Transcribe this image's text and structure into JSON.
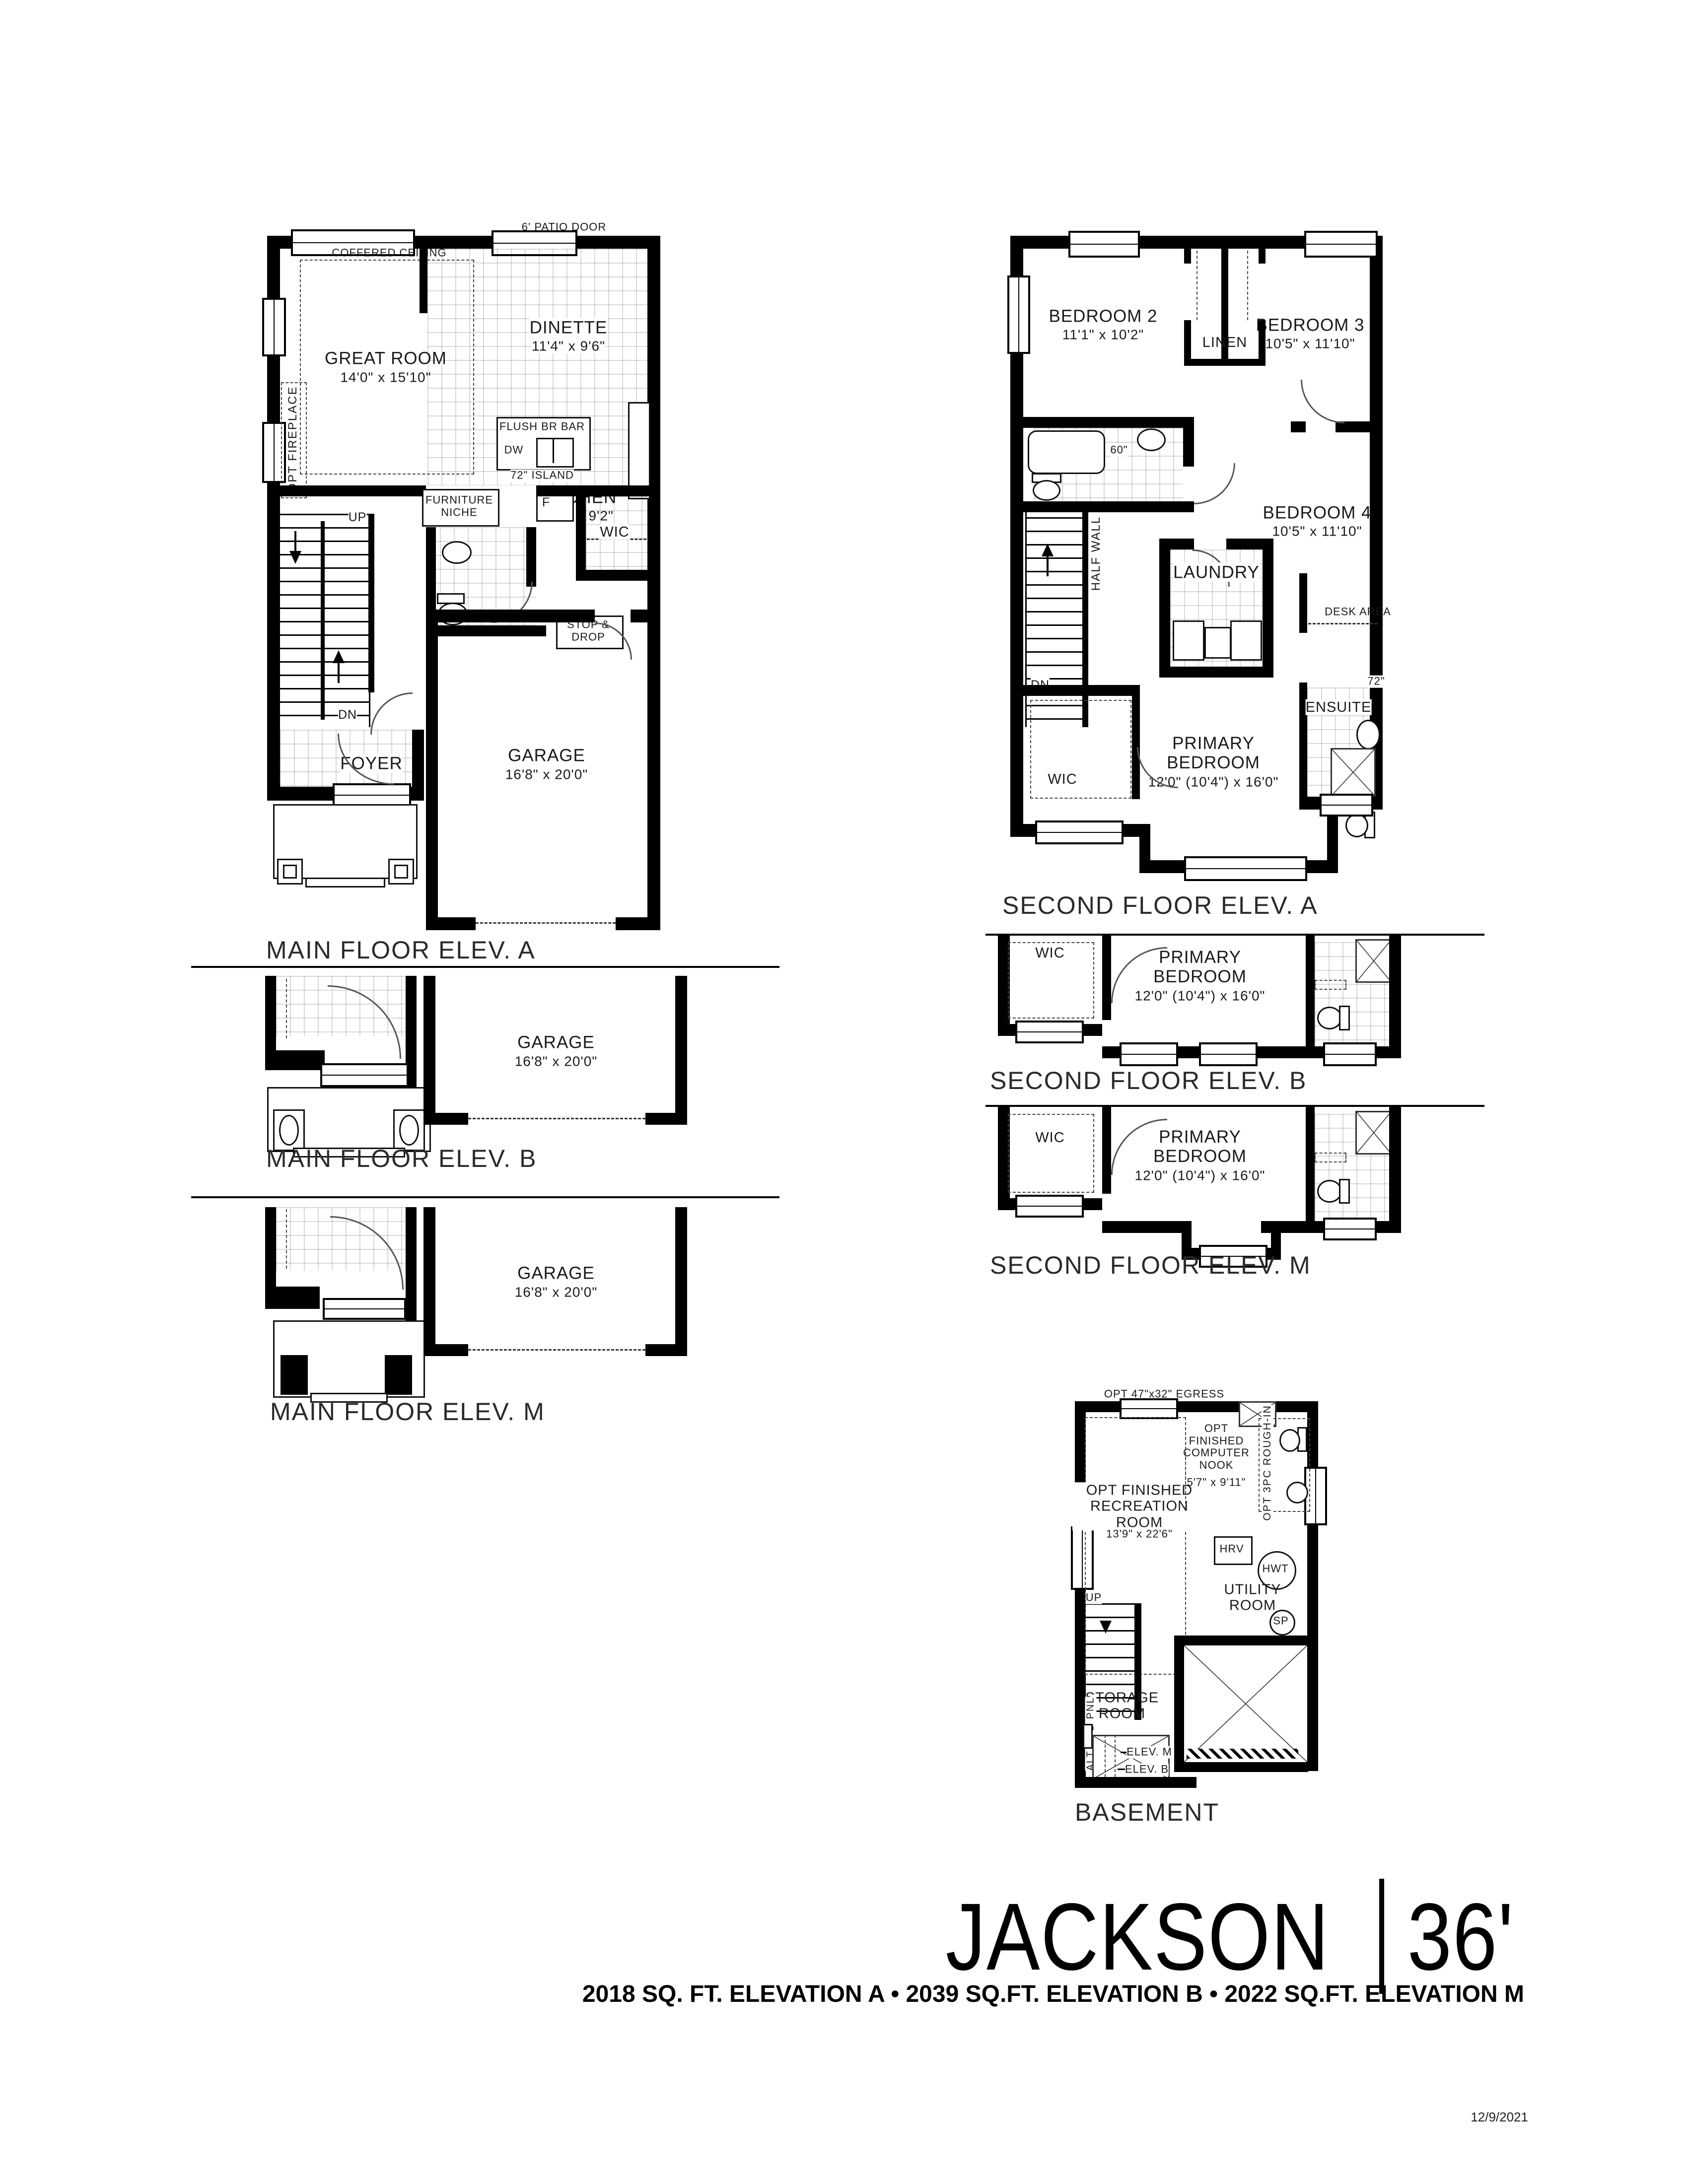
{
  "title_block": {
    "name": "JACKSON",
    "separator": "|",
    "size": "36'",
    "subtitle": "2018 SQ. FT. ELEVATION A • 2039 SQ.FT. ELEVATION B • 2022 SQ.FT. ELEVATION M",
    "date": "12/9/2021"
  },
  "captions": {
    "main_a": "MAIN FLOOR ELEV. A",
    "main_b": "MAIN FLOOR ELEV. B",
    "main_m": "MAIN FLOOR ELEV. M",
    "second_a": "SECOND FLOOR ELEV. A",
    "second_b": "SECOND FLOOR ELEV. B",
    "second_m": "SECOND FLOOR ELEV. M",
    "basement": "BASEMENT"
  },
  "main_floor": {
    "patio_door": "6' PATIO DOOR",
    "coffered_ceiling": "COFFERED CEILING",
    "great_room": {
      "name": "GREAT ROOM",
      "dims": "14'0\" x 15'10\""
    },
    "opt_fireplace": "OPT FIREPLACE",
    "dinette": {
      "name": "DINETTE",
      "dims": "11'4\" x 9'6\""
    },
    "kitchen": {
      "name": "KITCHEN",
      "dims": "11'4\" x 9'2\""
    },
    "flush_br_bar": "FLUSH BR BAR",
    "dw": "DW",
    "island": "72\" ISLAND",
    "fridge": "F",
    "furniture_niche": "FURNITURE NICHE",
    "wic": "WIC",
    "stop_drop": "STOP & DROP",
    "up": "UP",
    "dn": "DN",
    "foyer": "FOYER",
    "garage": {
      "name": "GARAGE",
      "dims": "16'8\" x 20'0\""
    }
  },
  "second_floor": {
    "bedroom2": {
      "name": "BEDROOM 2",
      "dims": "11'1\" x 10'2\""
    },
    "bedroom3": {
      "name": "BEDROOM 3",
      "dims": "10'5\" x 11'10\""
    },
    "bedroom4": {
      "name": "BEDROOM 4",
      "dims": "10'5\" x 11'10\""
    },
    "linen": "LINEN",
    "vanity_60": "60\"",
    "laundry": "LAUNDRY",
    "half_wall": "HALF WALL",
    "dn": "DN",
    "desk_area": "DESK AREA",
    "ensuite": "ENSUITE",
    "vanity_72": "72\"",
    "primary": {
      "name": "PRIMARY BEDROOM",
      "dims": "12'0\" (10'4\") x 16'0\""
    },
    "wic": "WIC"
  },
  "basement": {
    "egress": "OPT 47\"x32\" EGRESS",
    "computer_nook": {
      "name": "OPT FINISHED COMPUTER NOOK",
      "dims": "5'7\" x 9'11\""
    },
    "rough_in": "OPT 3PC ROUGH-IN",
    "rec_room": {
      "name": "OPT FINISHED RECREATION ROOM",
      "dims": "13'9\" x 22'6\""
    },
    "hrv": "HRV",
    "hwt": "HWT",
    "utility_room": "UTILITY ROOM",
    "sp": "SP",
    "up": "UP",
    "furnace": "F",
    "wm": "WM",
    "hyd_pnl": "HYD PNL",
    "storage_room": "STORAGE ROOM",
    "alt_hyd_pnl": "ALT HYD PNL",
    "elev_m": "ELEV. M",
    "elev_b": "ELEV. B"
  }
}
